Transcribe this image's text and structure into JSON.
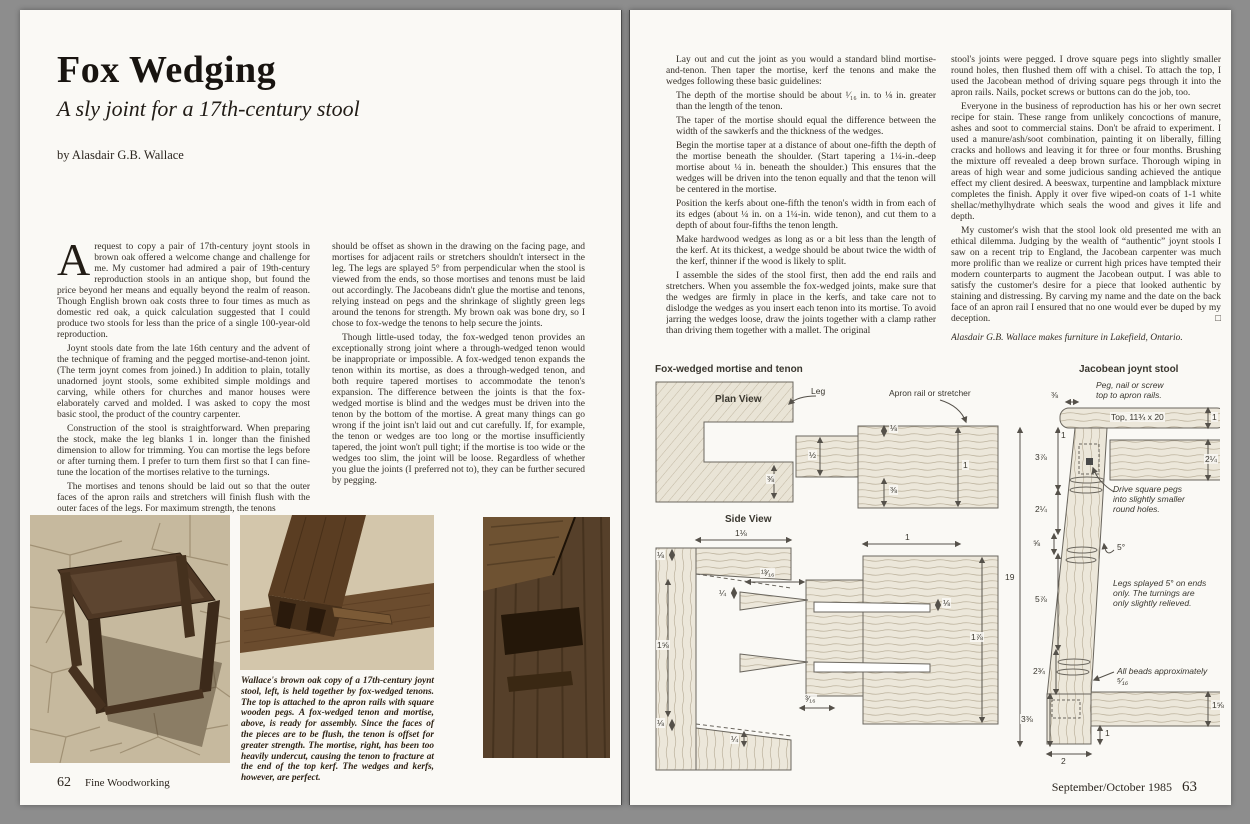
{
  "colors": {
    "background": "#8d8d8d",
    "page": "#faf9f5",
    "ink": "#332d25",
    "sepia_dark": "#4a351f",
    "sepia_light": "#c6b99e"
  },
  "left_page": {
    "title": "Fox Wedging",
    "subtitle": "A sly joint for a 17th-century stool",
    "byline": "by Alasdair G.B. Wallace",
    "col1": {
      "dropcap": "A",
      "p1": "request to copy a pair of 17th-century joynt stools in brown oak offered a welcome change and challenge for me. My customer had admired a pair of 19th-century reproduction stools in an antique shop, but found the price beyond her means and equally beyond the realm of reason. Though English brown oak costs three to four times as much as domestic red oak, a quick calculation suggested that I could produce two stools for less than the price of a single 100-year-old reproduction.",
      "p2": "Joynt stools date from the late 16th century and the advent of the technique of framing and the pegged mortise-and-tenon joint. (The term joynt comes from joined.) In addition to plain, totally unadorned joynt stools, some exhibited simple moldings and carving, while others for churches and manor houses were elaborately carved and molded. I was asked to copy the most basic stool, the product of the country carpenter.",
      "p3": "Construction of the stool is straightforward. When preparing the stock, make the leg blanks 1 in. longer than the finished dimension to allow for trimming. You can mortise the legs before or after turning them. I prefer to turn them first so that I can fine-tune the location of the mortises relative to the turnings.",
      "p4": "The mortises and tenons should be laid out so that the outer faces of the apron rails and stretchers will finish flush with the outer faces of the legs. For maximum strength, the tenons"
    },
    "col2": {
      "p1": "should be offset as shown in the drawing on the facing page, and mortises for adjacent rails or stretchers shouldn't intersect in the leg. The legs are splayed 5° from perpendicular when the stool is viewed from the ends, so those mortises and tenons must be laid out accordingly. The Jacobeans didn't glue the mortise and tenons, relying instead on pegs and the shrinkage of slightly green legs around the tenons for strength. My brown oak was bone dry, so I chose to fox-wedge the tenons to help secure the joints.",
      "p2": "Though little-used today, the fox-wedged tenon provides an exceptionally strong joint where a through-wedged tenon would be inappropriate or impossible. A fox-wedged tenon expands the tenon within its mortise, as does a through-wedged tenon, and both require tapered mortises to accommodate the tenon's expansion. The difference between the joints is that the fox-wedged mortise is blind and the wedges must be driven into the tenon by the bottom of the mortise. A great many things can go wrong if the joint isn't laid out and cut carefully. If, for example, the tenon or wedges are too long or the mortise insufficiently tapered, the joint won't pull tight; if the mortise is too wide or the wedges too slim, the joint will be loose. Regardless of whether you glue the joints (I preferred not to), they can be further secured by pegging."
    },
    "caption": "Wallace's brown oak copy of a 17th-century joynt stool, left, is held together by fox-wedged tenons. The top is attached to the apron rails with square wooden pegs. A fox-wedged tenon and mortise, above, is ready for assembly. Since the faces of the pieces are to be flush, the tenon is offset for greater strength. The mortise, right, has been too heavily undercut, causing the tenon to fracture at the end of the top kerf. The wedges and kerfs, however, are perfect.",
    "footer_page": "62",
    "footer_title": "Fine Woodworking"
  },
  "right_page": {
    "col1": {
      "intro": "Lay out and cut the joint as you would a standard blind mortise-and-tenon. Then taper the mortise, kerf the tenons and make the wedges following these basic guidelines:",
      "g1": "The depth of the mortise should be about ¹⁄₁₆ in. to ⅛ in. greater than the length of the tenon.",
      "g2": "The taper of the mortise should equal the difference between the width of the sawkerfs and the thickness of the wedges.",
      "g3": "Begin the mortise taper at a distance of about one-fifth the depth of the mortise beneath the shoulder. (Start tapering a 1¼-in.-deep mortise about ¼ in. beneath the shoulder.) This ensures that the wedges will be driven into the tenon equally and that the tenon will be centered in the mortise.",
      "g4": "Position the kerfs about one-fifth the tenon's width in from each of its edges (about ¼ in. on a 1¼-in. wide tenon), and cut them to a depth of about four-fifths the tenon length.",
      "g5": "Make hardwood wedges as long as or a bit less than the length of the kerf. At its thickest, a wedge should be about twice the width of the kerf, thinner if the wood is likely to split.",
      "closing": "I assemble the sides of the stool first, then add the end rails and stretchers. When you assemble the fox-wedged joints, make sure that the wedges are firmly in place in the kerfs, and take care not to dislodge the wedges as you insert each tenon into its mortise. To avoid jarring the wedges loose, draw the joints together with a clamp rather than driving them together with a mallet. The original"
    },
    "col2": {
      "p1": "stool's joints were pegged. I drove square pegs into slightly smaller round holes, then flushed them off with a chisel. To attach the top, I used the Jacobean method of driving square pegs through it into the apron rails. Nails, pocket screws or buttons can do the job, too.",
      "p2": "Everyone in the business of reproduction has his or her own secret recipe for stain. These range from unlikely concoctions of manure, ashes and soot to commercial stains. Don't be afraid to experiment. I used a manure/ash/soot combination, painting it on liberally, filling cracks and hollows and leaving it for three or four months. Brushing the mixture off revealed a deep brown surface. Thorough wiping in areas of high wear and some judicious sanding achieved the antique effect my client desired. A beeswax, turpentine and lampblack mixture completes the finish. Apply it over five wiped-on coats of 1-1 white shellac/methylhydrate which seals the wood and gives it life and depth.",
      "p3": "My customer's wish that the stool look old presented me with an ethical dilemma. Judging by the wealth of “authentic” joynt stools I saw on a recent trip to England, the Jacobean carpenter was much more prolific than we realize or current high prices have tempted their modern counterparts to augment the Jacobean output. I was able to satisfy the customer's desire for a piece that looked authentic by staining and distressing. By carving my name and the date on the back face of an apron rail I ensured that no one would ever be duped by my deception.",
      "end_mark": "□",
      "author_note": "Alasdair G.B. Wallace makes furniture in Lakefield, Ontario."
    },
    "diagram": {
      "left_title": "Fox-wedged mortise and tenon",
      "plan_view": "Plan View",
      "leg": "Leg",
      "apron": "Apron rail or stretcher",
      "side_view": "Side View",
      "right_title": "Jacobean joynt stool",
      "note_peg_top": "Peg, nail or screw\ntop to apron rails.",
      "top_board": "Top, 11¾ x 20",
      "note_square_pegs": "Drive square pegs\ninto slightly smaller\nround holes.",
      "note_legs": "Legs splayed 5° on ends\nonly. The turnings are\nonly slightly relieved.",
      "note_beads": "All beads approximately ⁵⁄₁₆",
      "plan_dims": {
        "offset_top": "⅛",
        "tenon": "½",
        "offset_bottom": "⅜",
        "rail": "1",
        "leg_wall": "⅜"
      },
      "side_dims": {
        "rail_top": "1⅛",
        "taper_top": "⅛",
        "mortise_left": "1⅝",
        "wedge_thick": "¼",
        "wedge_len": "¹³⁄₁₆",
        "tenon_len": "1",
        "kerf": "⅛",
        "rail_height": "1⅞",
        "taper_off": "³⁄₁₆",
        "taper_bottom": "⅛",
        "bottom_quarter": "¼"
      },
      "stool_dims": {
        "top_overhang": "⅜",
        "top_thick": "1",
        "apron": "2¼",
        "leg_top": "1",
        "block_top": "3⅞",
        "block2": "2¼",
        "bead": "⅝",
        "total": "19",
        "turning": "5⅞",
        "splay": "5°",
        "lower": "2¾",
        "foot": "3⅜",
        "stretcher": "1⅝",
        "foot_tenon": "1",
        "foot_width": "2"
      }
    },
    "footer_issue": "September/October 1985",
    "footer_page": "63"
  }
}
